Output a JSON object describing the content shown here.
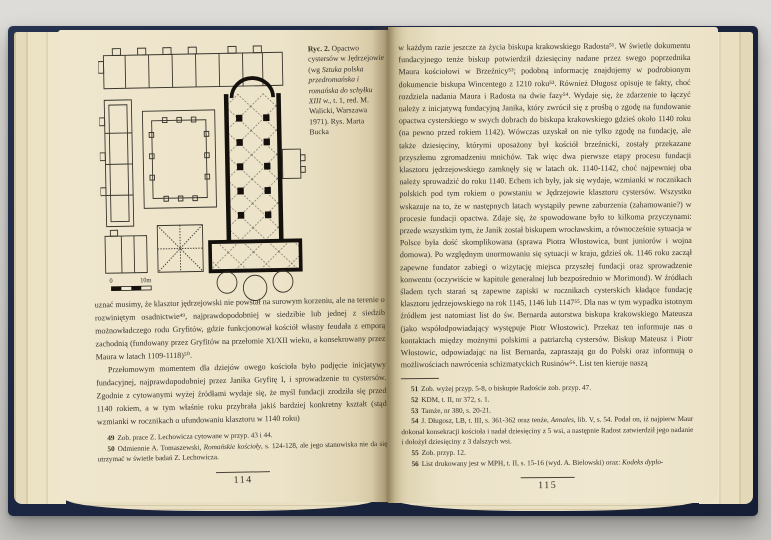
{
  "palette": {
    "cover_navy": "#1c2641",
    "page_cream": "#ece3c9",
    "ink": "#35312a"
  },
  "left_page": {
    "figure": {
      "caption": {
        "label": "Ryc. 2.",
        "pre_italic": " Opactwo cystersów w Jędrzejowie (wg ",
        "italic": "Sztuka polska przedromańska i romańska do schyłku XIII w.",
        "post_italic": ", t. 1, red. M. Walicki, Warszawa 1971). Rys. Marta Bucka"
      },
      "scale_zero": "0",
      "scale_ten": "10m"
    },
    "paragraphs": [
      "uznać musimy, że klasztor jędrzejowski nie powstał na surowym korzeniu, ale na terenie o rozwiniętym osadnictwie⁴⁹, najprawdopodobniej w siedzibie lub jednej z siedzib możnowładczego rodu Gryfitów, gdzie funkcjonował kościół własny feudała z emporą zachodnią (fundowany przez Gryfitów na przełomie XI/XII wieku, a konsekrowany przez Maura w latach 1109-1118)⁵⁰.",
      "Przełomowym momentem dla dziejów owego kościoła było podjęcie inicjatywy fundacyjnej, najprawdopodobniej przez Janika Gryfitę I, i sprowadzenie tu cystersów. Zgodnie z cytowanymi wyżej źródłami wydaje się, że myśl fundacji zrodziła się przed 1140 rokiem, a w tym właśnie roku przybrała jakiś bardziej konkretny kształt (stąd wzmianki w rocznikach o ufundowaniu klasztoru w 1140 roku)"
    ],
    "footnotes": [
      {
        "num": "49",
        "pre": "Zob. prace Z. Lechowicza cytowane w przyp. 43 i 44.",
        "italic": "",
        "post": ""
      },
      {
        "num": "50",
        "pre": "Odmiennie A. Tomaszewski, ",
        "italic": "Romańskie kościoły",
        "post": ", s. 124-128, ale jego stanowiska nie da się utrzymać w świetle badań Z. Lechowicza."
      }
    ],
    "page_number": "114"
  },
  "right_page": {
    "body": "w każdym razie jeszcze za życia biskupa krakowskiego Radosta⁵¹. W świetle dokumentu fundacyjnego tenże biskup potwierdził dziesięciny nadane przez swego poprzednika Maura kościołowi w Brzeźnicy⁵²; podobną informację znajdujemy w podrobionym dokumencie biskupa Wincentego z 1210 roku⁵³. Również Długosz opisuje te fakty, choć rozdziela nadania Maura i Radosta na dwie fazy⁵⁴. Wydaje się, że zdarzenie to łączyć należy z inicjatywą fundacyjną Janika, który zwrócił się z prośbą o zgodę na fundowanie opactwa cysterskiego w swych dobrach do biskupa krakowskiego gdzieś około 1140 roku (na pewno przed rokiem 1142). Wówczas uzyskał on nie tylko zgodę na fundację, ale także dziesięciny, którymi uposażony był kościół brzeźnicki, zostały przekazane przyszłemu zgromadzeniu mnichów. Tak więc dwa pierwsze etapy procesu fundacji klasztoru jędrzejowskiego zamknęły się w latach ok. 1140-1142, choć najpewniej oba należy sprowadzić do roku 1140. Echem ich były, jak się wydaje, wzmianki w rocznikach polskich pod tym rokiem o powstaniu w Jędrzejowie klasztoru cystersów. Wszystko wskazuje na to, że w następnych latach wystąpiły pewne zaburzenia (zahamowanie?) w procesie fundacji opactwa. Zdaje się, że spowodowane było to kilkoma przyczynami: przede wszystkim tym, że Janik został biskupem wrocławskim, a równocześnie sytuacja w Polsce była dość skomplikowana (sprawa Piotra Włostowica, bunt juniorów i wojna domowa). Po względnym unormowaniu się sytuacji w kraju, gdzieś ok. 1146 roku zaczął zapewne fundator zabiegi o wizytację miejsca przyszłej fundacji oraz sprowadzenie konwentu (oczywiście w kapitule generalnej lub bezpośrednio w Morimond). W źródłach śladem tych starań są zapewne zapiski w rocznikach cysterskich kładące fundację klasztoru jędrzejowskiego na rok 1145, 1146 lub 1147⁵⁵. Dla nas w tym wypadku istotnym źródłem jest natomiast list do św. Bernarda autorstwa biskupa krakowskiego Mateusza (jako współodpowiadający występuje Piotr Włostowic). Przekaz ten informuje nas o kontaktach między możnymi polskimi a patriarchą cystersów. Biskup Mateusz i Piotr Włostowic, odpowiadając na list Bernarda, zapraszają go do Polski oraz informują o możliwościach nawrócenia schizmatyckich Rusinów⁵⁶. List ten kieruje naszą",
    "footnotes": [
      {
        "num": "51",
        "pre": "Zob. wyżej przyp. 5-8, o biskupie Radoście zob. przyp. 47.",
        "italic": "",
        "post": ""
      },
      {
        "num": "52",
        "pre": "KDM, t. II, nr 372, s. 1.",
        "italic": "",
        "post": ""
      },
      {
        "num": "53",
        "pre": "Tamże, nr 380, s. 20-21.",
        "italic": "",
        "post": ""
      },
      {
        "num": "54",
        "pre": "J. Długosz, LB, t. III, s. 361-362 oraz tenże, ",
        "italic": "Annales",
        "post": ", lib. V, s. 54. Podał on, iż najpierw Maur dokonał konsekracji kościoła i nadał dziesięciny z 5 wsi, a następnie Radost zatwierdził jego nadanie i dołożył dziesięciny z 3 dalszych wsi."
      },
      {
        "num": "55",
        "pre": "Zob. przyp. 12.",
        "italic": "",
        "post": ""
      },
      {
        "num": "56",
        "pre": "List drukowany jest w MPH, t. II, s. 15-16 (wyd. A. Bielowski) oraz: ",
        "italic": "Kodeks dyplo-",
        "post": ""
      }
    ],
    "page_number": "115"
  }
}
